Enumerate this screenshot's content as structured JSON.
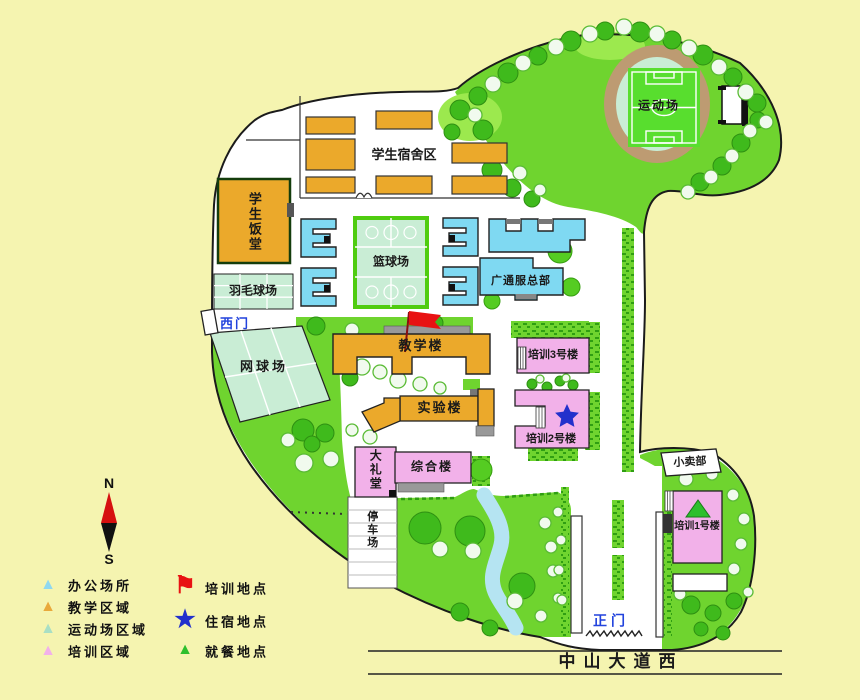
{
  "colors": {
    "outside_bg": "#F5F4B0",
    "campus_bg": "#FFFFFF",
    "green": "#6FD42F",
    "green_light": "#9CE94E",
    "mint": "#C9EDD5",
    "field_green": "#58DE2E",
    "court_border": "#4FCC10",
    "track_tan": "#BD9B72",
    "tree_dark": "#3FBA1C",
    "tree_light": "#55CC22",
    "orange": "#EBA92B",
    "blue": "#7FD9F2",
    "pink": "#F2B1E9",
    "stream": "#B5E4F2",
    "gray": "#9A9A9A",
    "label_blue": "#2243DD",
    "flag_red": "#E81212",
    "star_blue": "#2230CC",
    "hedge_dark": "#2F9E12",
    "compass_red": "#D61010",
    "compass_black": "#111111"
  },
  "labels": {
    "dorm_area": "学生宿舍区",
    "canteen": "学生饭堂",
    "badminton": "羽毛球场",
    "west_gate": "西门",
    "tennis": "网球场",
    "basketball": "篮球场",
    "teaching": "教学楼",
    "gtf_hq": "广通服总部",
    "training3": "培训3号楼",
    "training2": "培训2号楼",
    "lab": "实验楼",
    "complex": "综合楼",
    "auditorium": "大礼堂",
    "parking": "停车场",
    "shop": "小卖部",
    "training1": "培训1号楼",
    "main_gate": "正门",
    "sports_field": "运动场",
    "road": "中山大道西"
  },
  "compass": {
    "north": "N",
    "south": "S"
  },
  "legend": {
    "area_types": [
      {
        "label": "办公场所",
        "glyph": "▲",
        "color": "#8FD8F0"
      },
      {
        "label": "教学区域",
        "glyph": "▲",
        "color": "#E9A93B"
      },
      {
        "label": "运动场区域",
        "glyph": "▲",
        "color": "#A9DFC4"
      },
      {
        "label": "培训区域",
        "glyph": "▲",
        "color": "#F2B1E9"
      }
    ],
    "markers": [
      {
        "label": "培训地点",
        "glyph": "⚑",
        "color": "#E81212"
      },
      {
        "label": "住宿地点",
        "glyph": "★",
        "color": "#2230CC"
      },
      {
        "label": "就餐地点",
        "glyph": "▲",
        "color": "#2DBF2D"
      }
    ]
  }
}
